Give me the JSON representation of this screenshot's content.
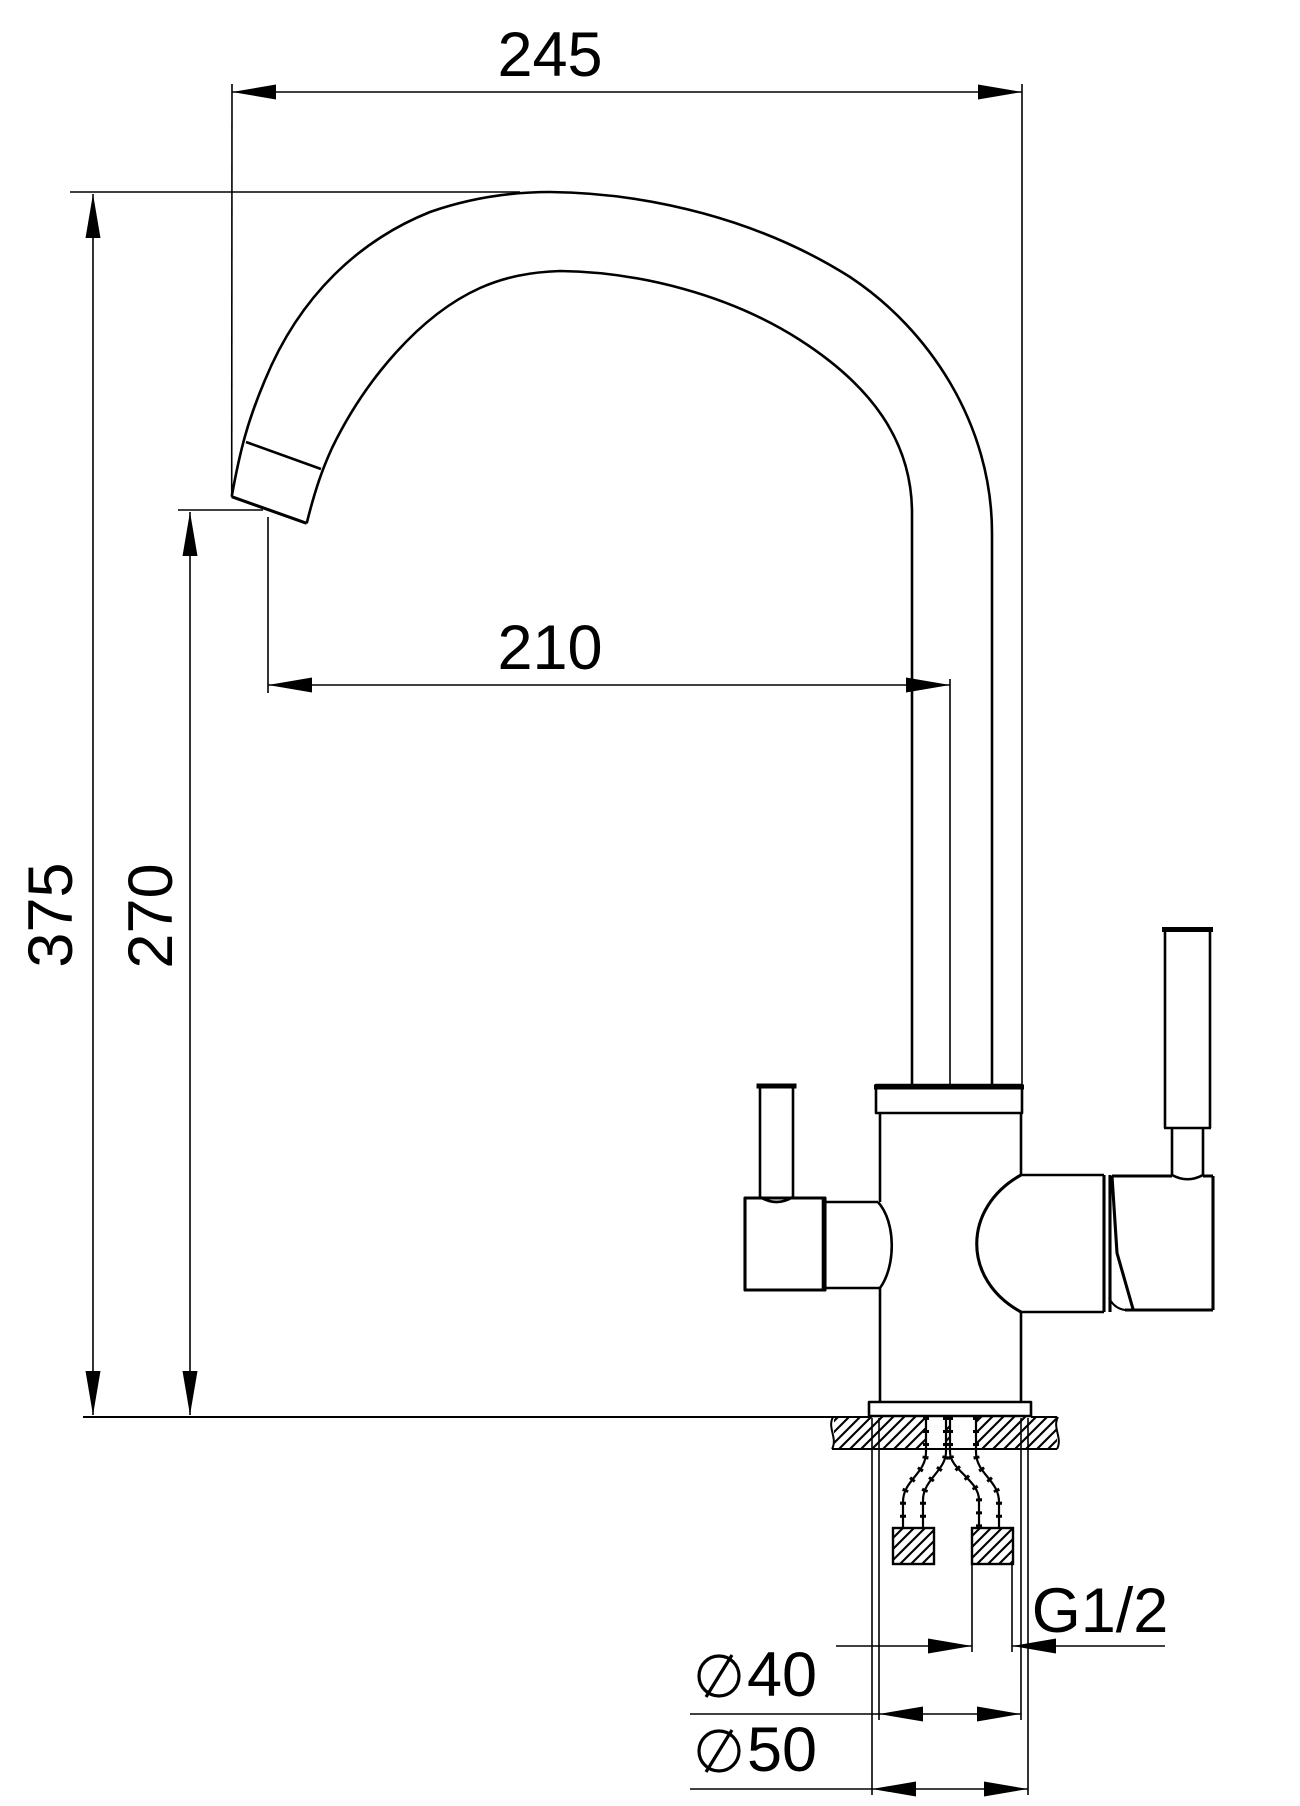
{
  "document": {
    "type": "technical-drawing",
    "subject": "kitchen faucet side elevation with mounting cross-section",
    "units": "mm",
    "background_color": "#ffffff",
    "line_color": "#000000"
  },
  "dimensions": {
    "spout_width": "245",
    "spout_reach": "210",
    "total_height": "375",
    "outlet_height": "270",
    "thread": "G1/2",
    "body_diameter": "40",
    "base_diameter": "50",
    "diameter_symbol": "circle-with-slash"
  }
}
